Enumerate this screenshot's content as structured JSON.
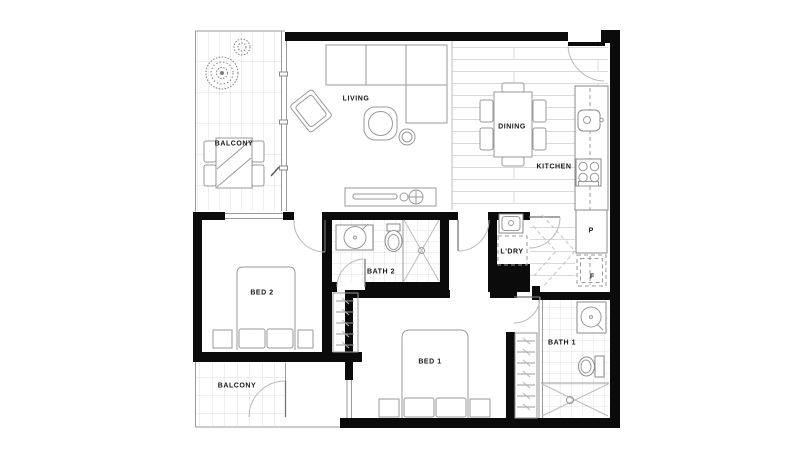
{
  "plan": {
    "type": "apartment-floor-plan",
    "style": {
      "wall_color": "#0b0b0b",
      "line_color": "#9a9a9a",
      "grid_color": "#e0e0e0",
      "text_color": "#161616"
    },
    "rooms": {
      "balcony_top": {
        "label": "BALCONY"
      },
      "living": {
        "label": "LIVING"
      },
      "dining": {
        "label": "DINING"
      },
      "kitchen": {
        "label": "KITCHEN"
      },
      "laundry": {
        "label": "L'DRY"
      },
      "bath2": {
        "label": "BATH 2"
      },
      "bed2": {
        "label": "BED 2"
      },
      "bed1": {
        "label": "BED 1"
      },
      "bath1": {
        "label": "BATH 1"
      },
      "balcony_bottom": {
        "label": "BALCONY"
      }
    },
    "cabinets": {
      "pantry": {
        "label": "P"
      },
      "fridge": {
        "label": "F"
      }
    }
  }
}
